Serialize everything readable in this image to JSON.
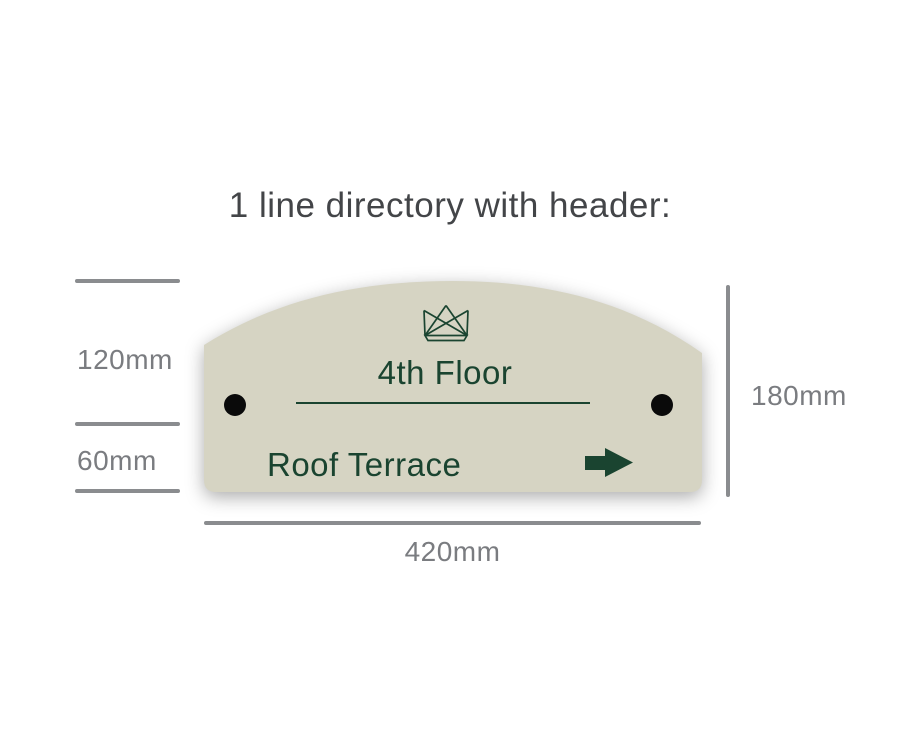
{
  "title": "1 line directory with header:",
  "title_color": "#434548",
  "sign": {
    "header_text": "4th Floor",
    "line_text": "Roof Terrace",
    "crown_icon": "crown-icon",
    "arrow_icon": "arrow-right-icon",
    "mounting_holes": 2,
    "background_color": "#d6d4c3",
    "text_color": "#1a4430",
    "mounting_hole_color": "#0a0a0a"
  },
  "dimensions": {
    "header_height": "120mm",
    "row_height": "60mm",
    "total_height": "180mm",
    "width": "420mm",
    "line_color": "#8a8c8f",
    "label_color": "#7a7c80"
  }
}
